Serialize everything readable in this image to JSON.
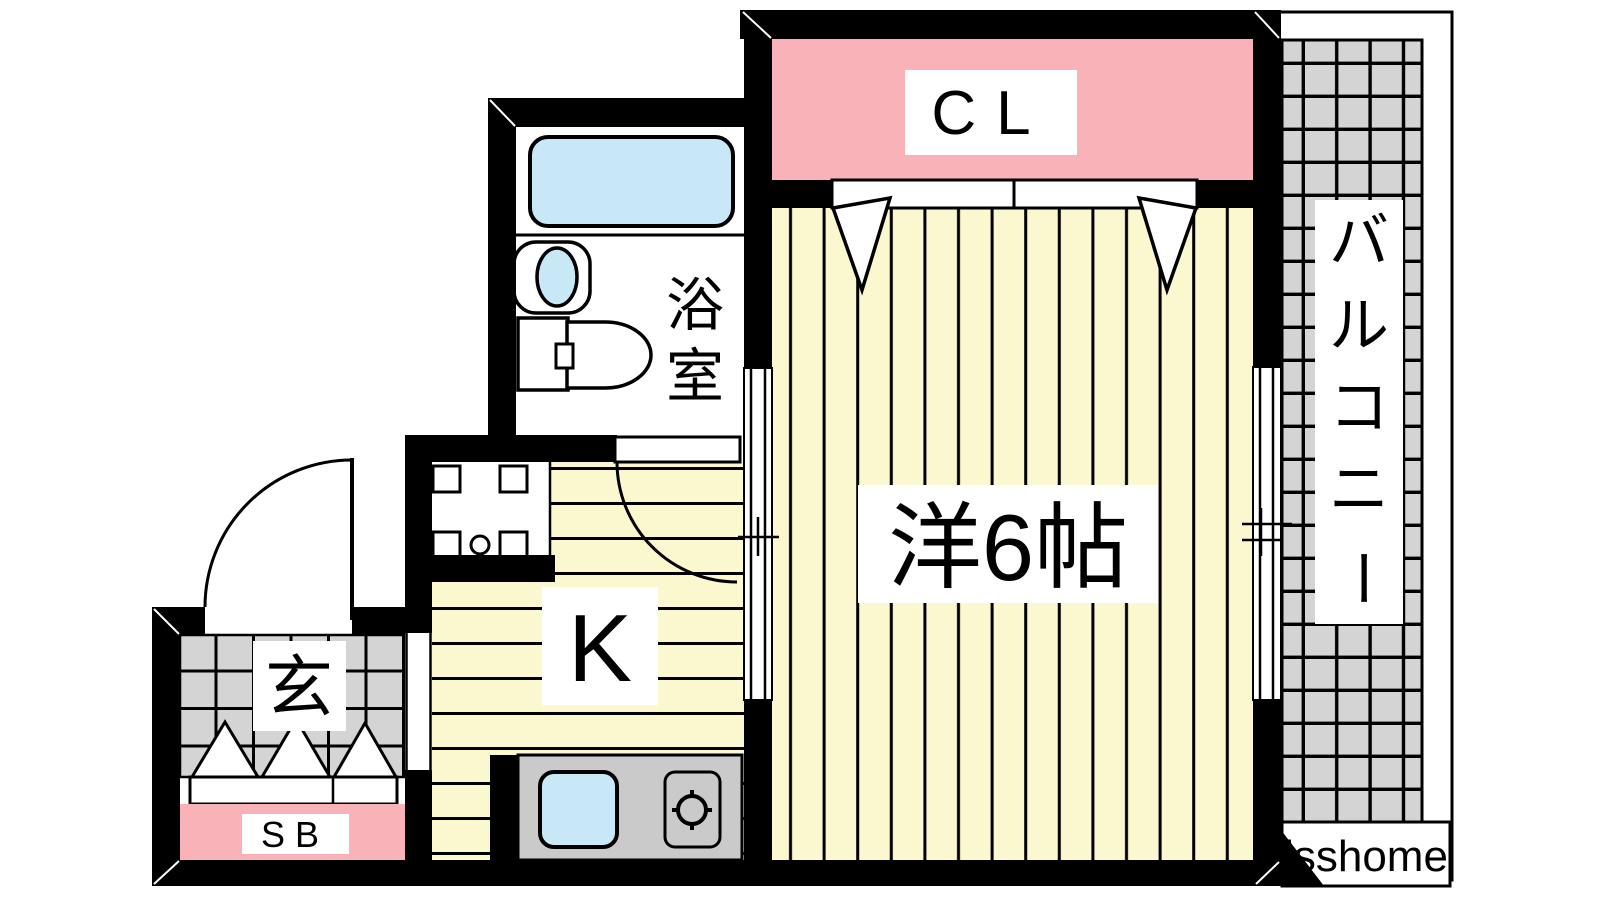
{
  "plan": {
    "rooms": {
      "closet": {
        "label": "CL"
      },
      "western_room": {
        "label": "洋6帖"
      },
      "kitchen": {
        "label": "K"
      },
      "bathroom": {
        "label": "浴室",
        "chars": [
          "浴",
          "室"
        ]
      },
      "entrance": {
        "label": "玄"
      },
      "shoe_box": {
        "label": "SB"
      },
      "balcony": {
        "label": "バルコニー",
        "chars": [
          "バ",
          "ル",
          "コ",
          "ニ",
          "ー"
        ]
      }
    },
    "watermark": "isshome",
    "colors": {
      "room_yellow": "#FBF7CE",
      "closet_pink": "#F9B2B7",
      "tile_gray": "#D4D4D4",
      "fixture_blue": "#C8E8F8",
      "counter_gray": "#CACACA",
      "wall_black": "#000000",
      "line_black": "#000000",
      "paper_white": "#FFFFFF"
    }
  }
}
